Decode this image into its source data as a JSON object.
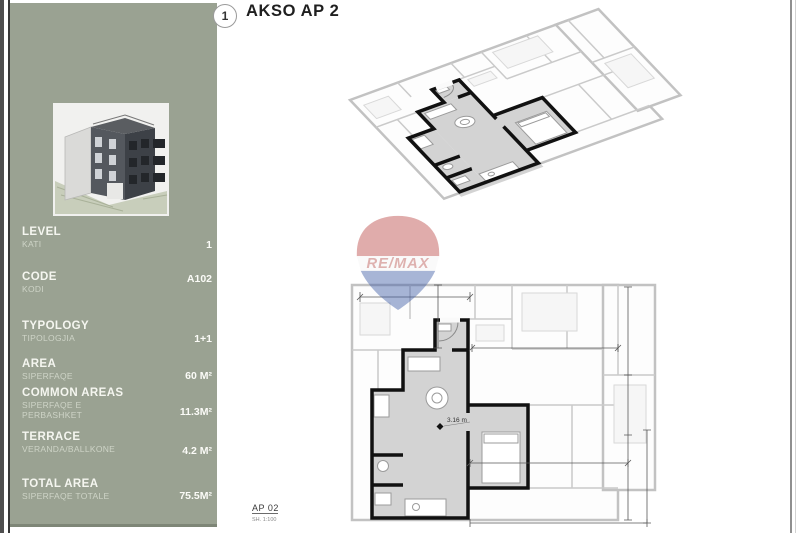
{
  "page": {
    "badge": "1",
    "title": "AKSO AP 2"
  },
  "sidebar": {
    "bg_color": "#9aa292",
    "thumbnail": "building-3d-render",
    "rows": [
      {
        "label": "LEVEL",
        "sublabel": "KATI",
        "value": "1"
      },
      {
        "label": "CODE",
        "sublabel": "KODI",
        "value": "A102"
      },
      {
        "label": "TYPOLOGY",
        "sublabel": "TIPOLOGJIA",
        "value": "1+1"
      },
      {
        "label": "AREA",
        "sublabel": "SIPERFAQE",
        "value": "60 M²"
      },
      {
        "label": "COMMON AREAS",
        "sublabel": "SIPERFAQE E PERBASHKET",
        "value": "11.3M²"
      },
      {
        "label": "TERRACE",
        "sublabel": "VERANDA/BALLKONE",
        "value": "4.2 M²"
      },
      {
        "label": "TOTAL AREA",
        "sublabel": "SIPERFAQE  TOTALE",
        "value": "75.5M²"
      }
    ]
  },
  "drawings": {
    "plan_label": "AP 02",
    "plan_scale": "SH. 1:100",
    "room_dimension": "3.16 m"
  },
  "watermark": {
    "brand": "RE/MAX",
    "red": "#bb4a46",
    "blue": "#3e5ca6"
  }
}
